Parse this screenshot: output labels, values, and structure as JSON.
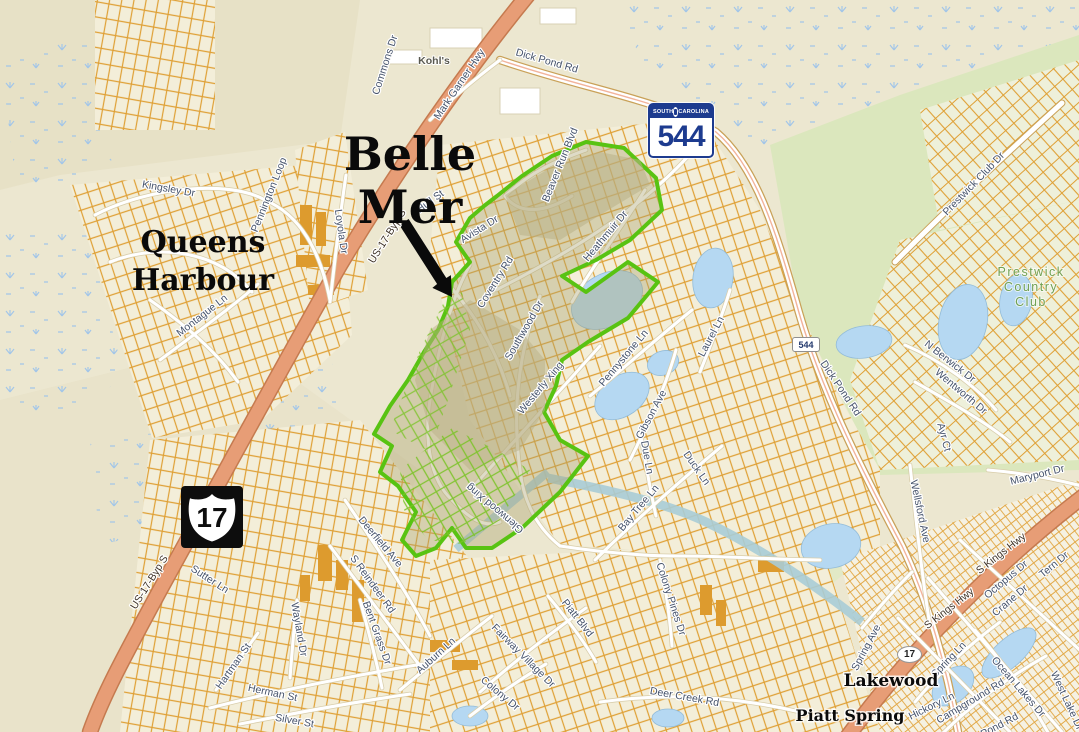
{
  "map": {
    "colors": {
      "background": "#ece7d0",
      "belle_mer_outline": "#58c312",
      "parcel_orange": "#dfa035",
      "highway_salmon": "#e79d76",
      "water_blue": "#b5d8f2",
      "golf_green": "#dbe7bd",
      "label_slate": "#46536b",
      "shield_blue": "#1d3b8f"
    },
    "shields": {
      "sc544": {
        "state_left": "SOUTH",
        "state_right": "CAROLINA",
        "number": "544"
      },
      "us17": {
        "number": "17"
      },
      "sc544_small": {
        "number": "544"
      },
      "us17_small": {
        "number": "17"
      }
    },
    "area_labels": [
      {
        "id": "belle-mer",
        "lines": [
          "Belle",
          "Mer"
        ],
        "x": 410,
        "y": 170,
        "lh": 53,
        "cls": "al-belle"
      },
      {
        "id": "queens-harbour",
        "lines": [
          "Queens",
          "Harbour"
        ],
        "x": 203,
        "y": 252,
        "lh": 38,
        "cls": "al-queens"
      },
      {
        "id": "lakewood",
        "lines": [
          "Lakewood"
        ],
        "x": 891,
        "y": 686,
        "lh": 20,
        "cls": "al-town"
      },
      {
        "id": "piatt-spring",
        "lines": [
          "Piatt Spring"
        ],
        "x": 850,
        "y": 721,
        "lh": 18,
        "cls": "al-town-sm"
      },
      {
        "id": "prestwick-country-club",
        "lines": [
          "Prestwick",
          "Country",
          "Club"
        ],
        "x": 1031,
        "y": 276,
        "lh": 15,
        "cls": "al-green"
      }
    ],
    "road_labels": [
      {
        "t": "Dick Pond Rd",
        "x": 546,
        "y": 64,
        "r": 16
      },
      {
        "t": "Mark Garner Hwy",
        "x": 462,
        "y": 86,
        "r": -56
      },
      {
        "t": "Commons Dr",
        "x": 388,
        "y": 66,
        "r": -72
      },
      {
        "t": "US-17-Byp S",
        "x": 390,
        "y": 238,
        "r": -58,
        "c": "hwy"
      },
      {
        "t": "US-17-Byp S",
        "x": 152,
        "y": 584,
        "r": -58,
        "c": "hwy"
      },
      {
        "t": "Loyola Dr",
        "x": 338,
        "y": 232,
        "r": 82
      },
      {
        "t": "Kingsley Dr",
        "x": 168,
        "y": 192,
        "r": 10
      },
      {
        "t": "Pennington Loop",
        "x": 272,
        "y": 196,
        "r": -68
      },
      {
        "t": "Montague Ln",
        "x": 204,
        "y": 318,
        "r": -38
      },
      {
        "t": "Kohl's",
        "x": 434,
        "y": 64,
        "r": 0,
        "c": "poi"
      },
      {
        "t": "Beaver Run Blvd",
        "x": 563,
        "y": 166,
        "r": -68
      },
      {
        "t": "Hull St",
        "x": 432,
        "y": 204,
        "r": -36
      },
      {
        "t": "Avista Dr",
        "x": 481,
        "y": 232,
        "r": -32
      },
      {
        "t": "Coventry Rd",
        "x": 498,
        "y": 284,
        "r": -58
      },
      {
        "t": "Heathmuir Dr",
        "x": 608,
        "y": 238,
        "r": -50
      },
      {
        "t": "Southwood Dr",
        "x": 527,
        "y": 332,
        "r": -60
      },
      {
        "t": "Westerly Xing",
        "x": 543,
        "y": 390,
        "r": -50
      },
      {
        "t": "Pennystone Ln",
        "x": 626,
        "y": 360,
        "r": -50
      },
      {
        "t": "Gibson Ave",
        "x": 654,
        "y": 416,
        "r": -62
      },
      {
        "t": "Laurel Ln",
        "x": 714,
        "y": 338,
        "r": -62
      },
      {
        "t": "Due Ln",
        "x": 644,
        "y": 458,
        "r": 80
      },
      {
        "t": "Duck Ln",
        "x": 694,
        "y": 470,
        "r": 55
      },
      {
        "t": "Bay Tree Ln",
        "x": 641,
        "y": 510,
        "r": -50
      },
      {
        "t": "Glenwood Xing",
        "x": 497,
        "y": 506,
        "r": -140
      },
      {
        "t": "Deerfield Ave",
        "x": 378,
        "y": 544,
        "r": 50
      },
      {
        "t": "S Reindeer Rd",
        "x": 370,
        "y": 586,
        "r": 54
      },
      {
        "t": "Sutter Ln",
        "x": 208,
        "y": 582,
        "r": 33
      },
      {
        "t": "Wayland Dr",
        "x": 296,
        "y": 630,
        "r": 80
      },
      {
        "t": "Herman St",
        "x": 272,
        "y": 696,
        "r": 12
      },
      {
        "t": "Hartman St",
        "x": 236,
        "y": 668,
        "r": -55
      },
      {
        "t": "Silver St",
        "x": 294,
        "y": 724,
        "r": 10
      },
      {
        "t": "Bent Grass Dr",
        "x": 374,
        "y": 634,
        "r": 70
      },
      {
        "t": "Auburn Ln",
        "x": 438,
        "y": 658,
        "r": -42
      },
      {
        "t": "Colony Dr",
        "x": 498,
        "y": 696,
        "r": 40
      },
      {
        "t": "Fairway Village Dr",
        "x": 521,
        "y": 658,
        "r": 45
      },
      {
        "t": "Piatt Blvd",
        "x": 575,
        "y": 620,
        "r": 52
      },
      {
        "t": "Colony Pines Dr",
        "x": 668,
        "y": 600,
        "r": 72
      },
      {
        "t": "Deer Creek Rd",
        "x": 684,
        "y": 700,
        "r": 10
      },
      {
        "t": "Dick Pond Rd",
        "x": 838,
        "y": 390,
        "r": 56
      },
      {
        "t": "Wellsford Ave",
        "x": 917,
        "y": 512,
        "r": 78
      },
      {
        "t": "Maryport Dr",
        "x": 1038,
        "y": 478,
        "r": -14
      },
      {
        "t": "Prestwick Club Dr",
        "x": 976,
        "y": 186,
        "r": -46
      },
      {
        "t": "N Berwick Dr",
        "x": 948,
        "y": 364,
        "r": 38
      },
      {
        "t": "Wentworth Dr",
        "x": 959,
        "y": 394,
        "r": 40
      },
      {
        "t": "Ayr Ct",
        "x": 941,
        "y": 438,
        "r": 75
      },
      {
        "t": "S Kings Hwy",
        "x": 951,
        "y": 611,
        "r": -38,
        "c": "hwy"
      },
      {
        "t": "S Kings Hwy",
        "x": 1003,
        "y": 556,
        "r": -38,
        "c": "hwy"
      },
      {
        "t": "Octopus Dr",
        "x": 1008,
        "y": 582,
        "r": -40
      },
      {
        "t": "Crane Dr",
        "x": 1012,
        "y": 603,
        "r": -40
      },
      {
        "t": "Tern Dr",
        "x": 1056,
        "y": 567,
        "r": -40
      },
      {
        "t": "Spring Ave",
        "x": 869,
        "y": 649,
        "r": -62
      },
      {
        "t": "Spring Ln",
        "x": 951,
        "y": 662,
        "r": -46
      },
      {
        "t": "Hickory Ln",
        "x": 933,
        "y": 709,
        "r": -26
      },
      {
        "t": "Campground Rd",
        "x": 972,
        "y": 704,
        "r": -31
      },
      {
        "t": "Ocean Lakes Dr",
        "x": 1016,
        "y": 689,
        "r": 49
      },
      {
        "t": "Pond Rd",
        "x": 1001,
        "y": 728,
        "r": -28
      },
      {
        "t": "West Lake Dr",
        "x": 1064,
        "y": 702,
        "r": 65
      }
    ]
  }
}
